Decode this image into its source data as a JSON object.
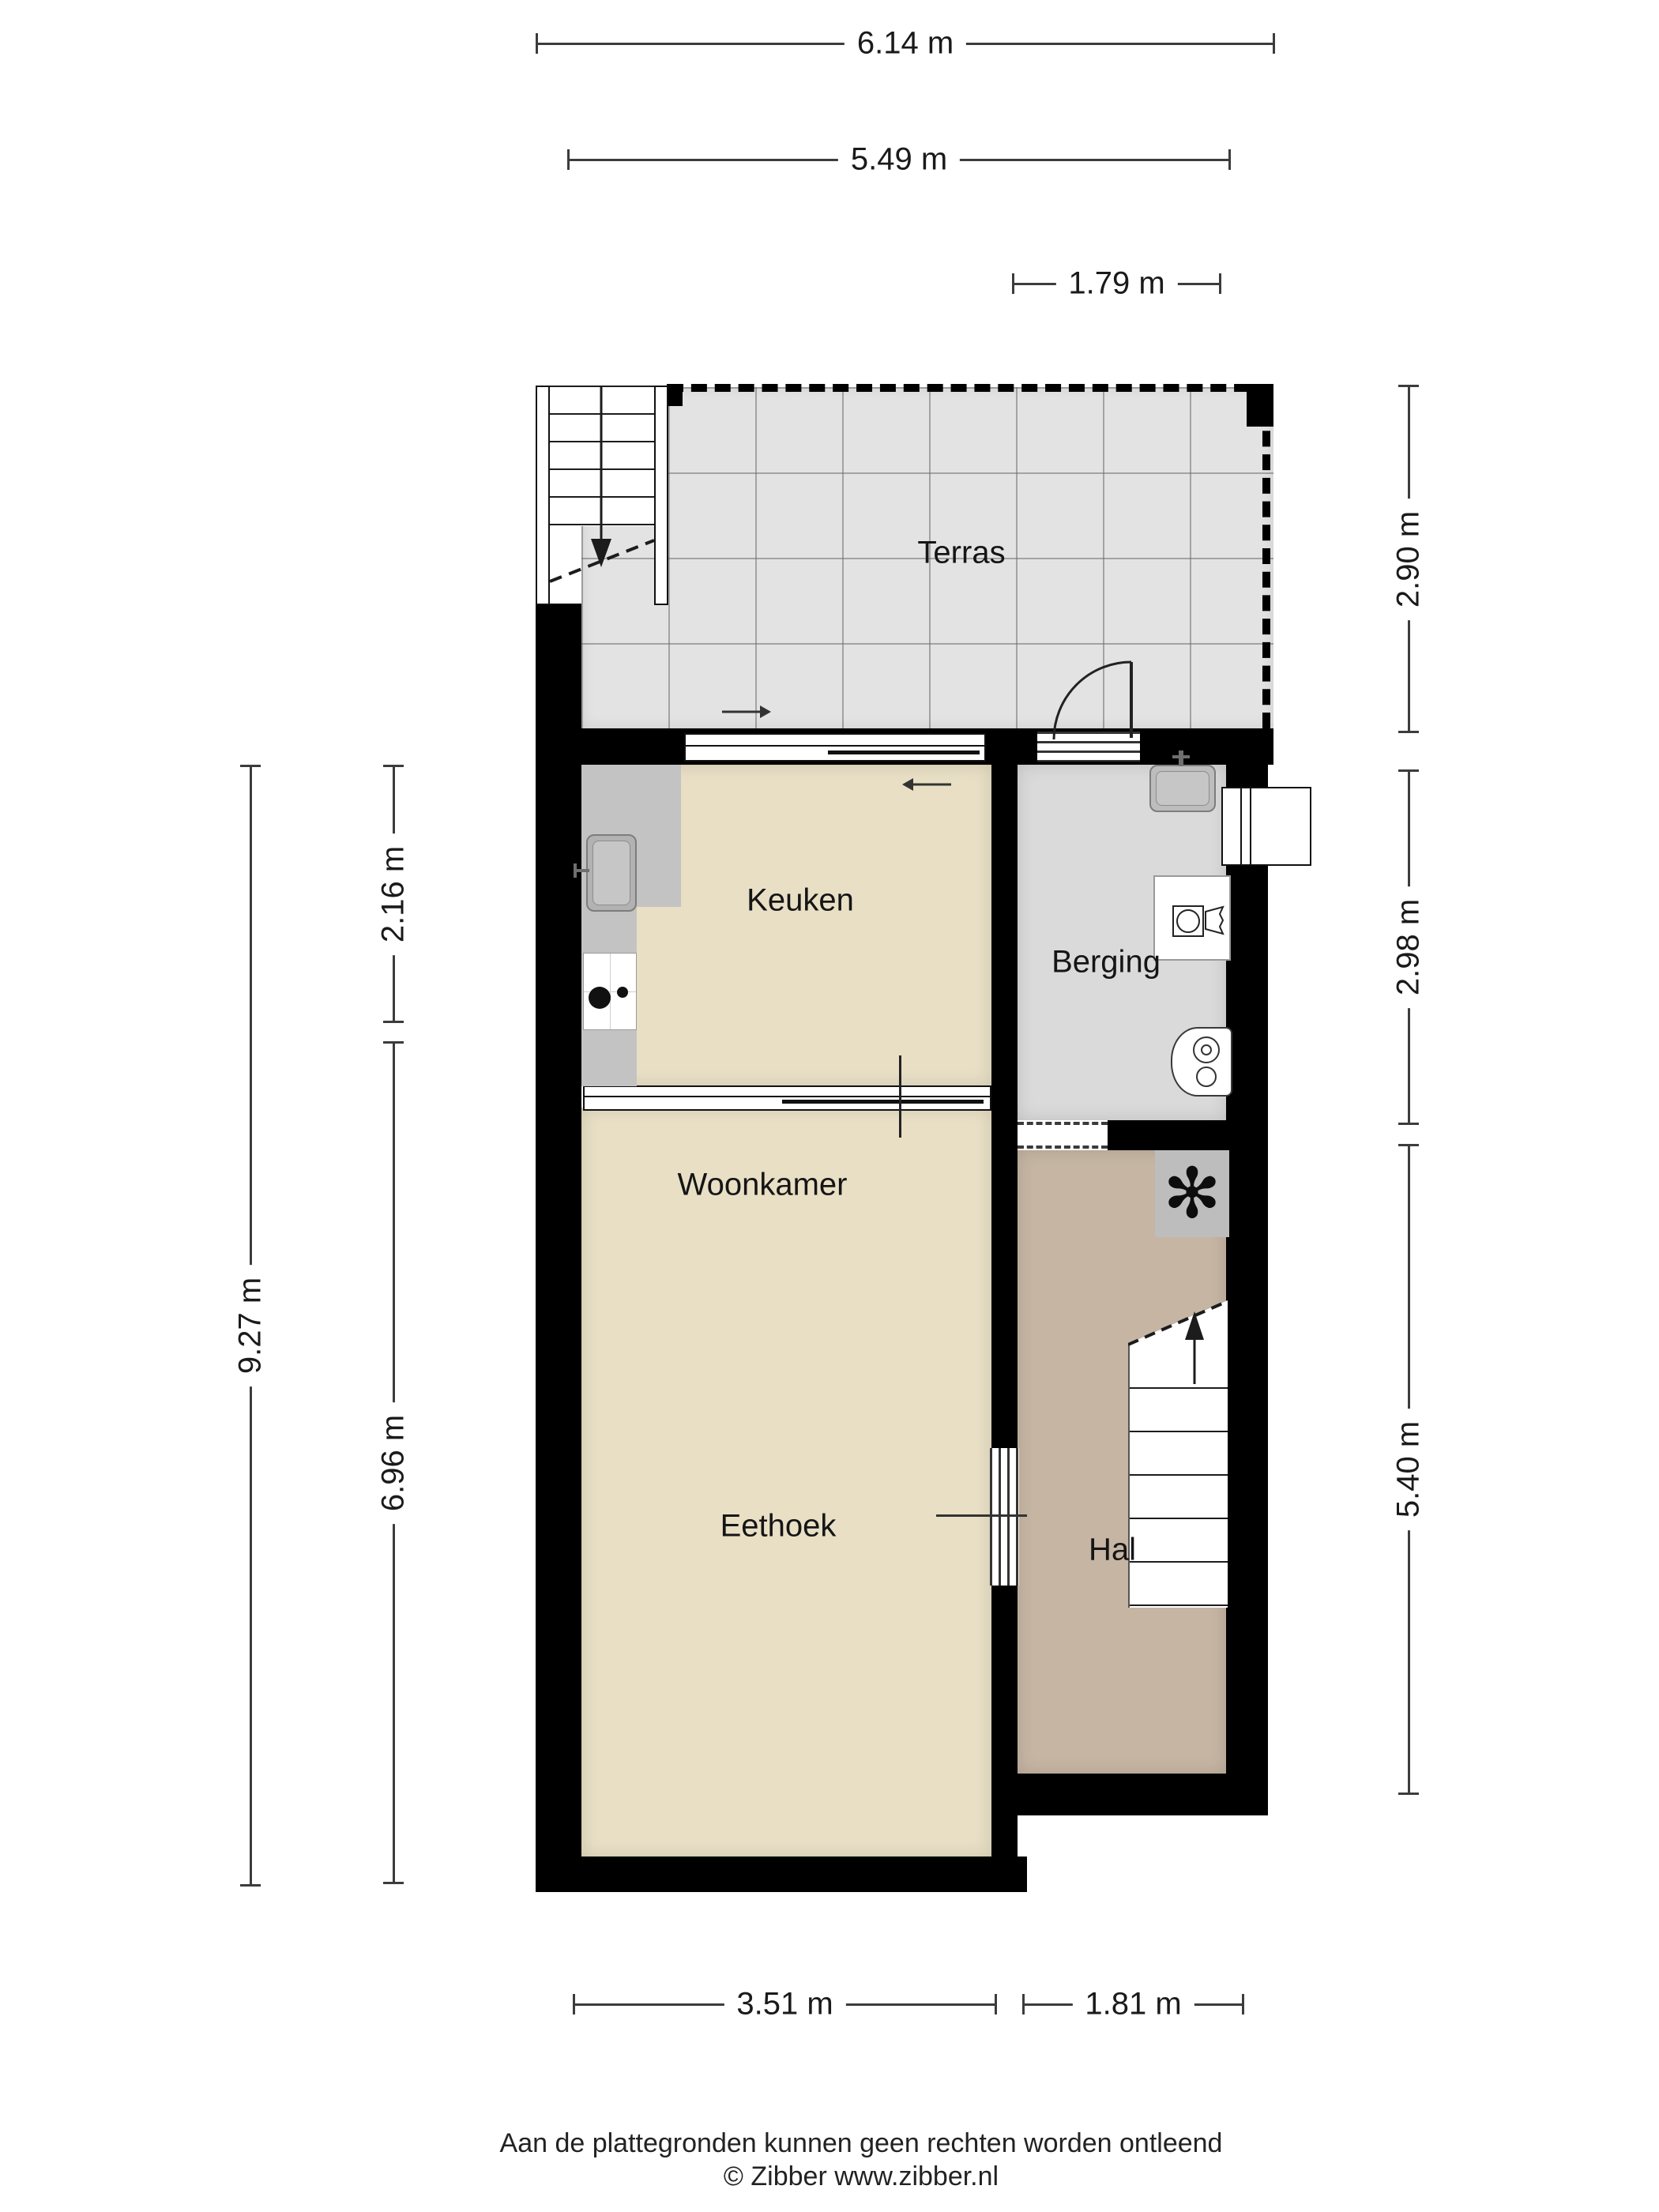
{
  "plan": {
    "type": "floorplan",
    "rooms": {
      "terras": "Terras",
      "keuken": "Keuken",
      "berging": "Berging",
      "woonkamer": "Woonkamer",
      "eethoek": "Eethoek",
      "hal": "Hal"
    },
    "dims": {
      "top_full": "6.14 m",
      "top_inner": "5.49 m",
      "top_right": "1.79 m",
      "left_full": "9.27 m",
      "left_keuken": "2.16 m",
      "left_living": "6.96 m",
      "right_terras": "2.90 m",
      "right_berging": "2.98 m",
      "right_hal": "5.40 m",
      "bottom_living": "3.51 m",
      "bottom_hal": "1.81 m"
    },
    "icons": {
      "extractor_fan": "✻",
      "names": [
        "staircase-down",
        "staircase-up",
        "door-swing",
        "sliding-door",
        "window",
        "kitchen-sink",
        "stove",
        "berging-sink",
        "washing-machine",
        "laundry-basket",
        "boiler",
        "extractor-fan"
      ]
    },
    "colors": {
      "wall": "#000000",
      "floor_living": "#e8dfc5",
      "floor_berging": "#dadada",
      "floor_hal": "#c6b5a3",
      "terrace_tile": "#e3e3e3",
      "counter": "#c3c3c3",
      "dimension_line": "#3c3c3c",
      "text": "#1a1a1a"
    }
  },
  "footer": {
    "disclaimer": "Aan de plattegronden kunnen geen rechten worden ontleend",
    "copyright": "© Zibber www.zibber.nl"
  }
}
